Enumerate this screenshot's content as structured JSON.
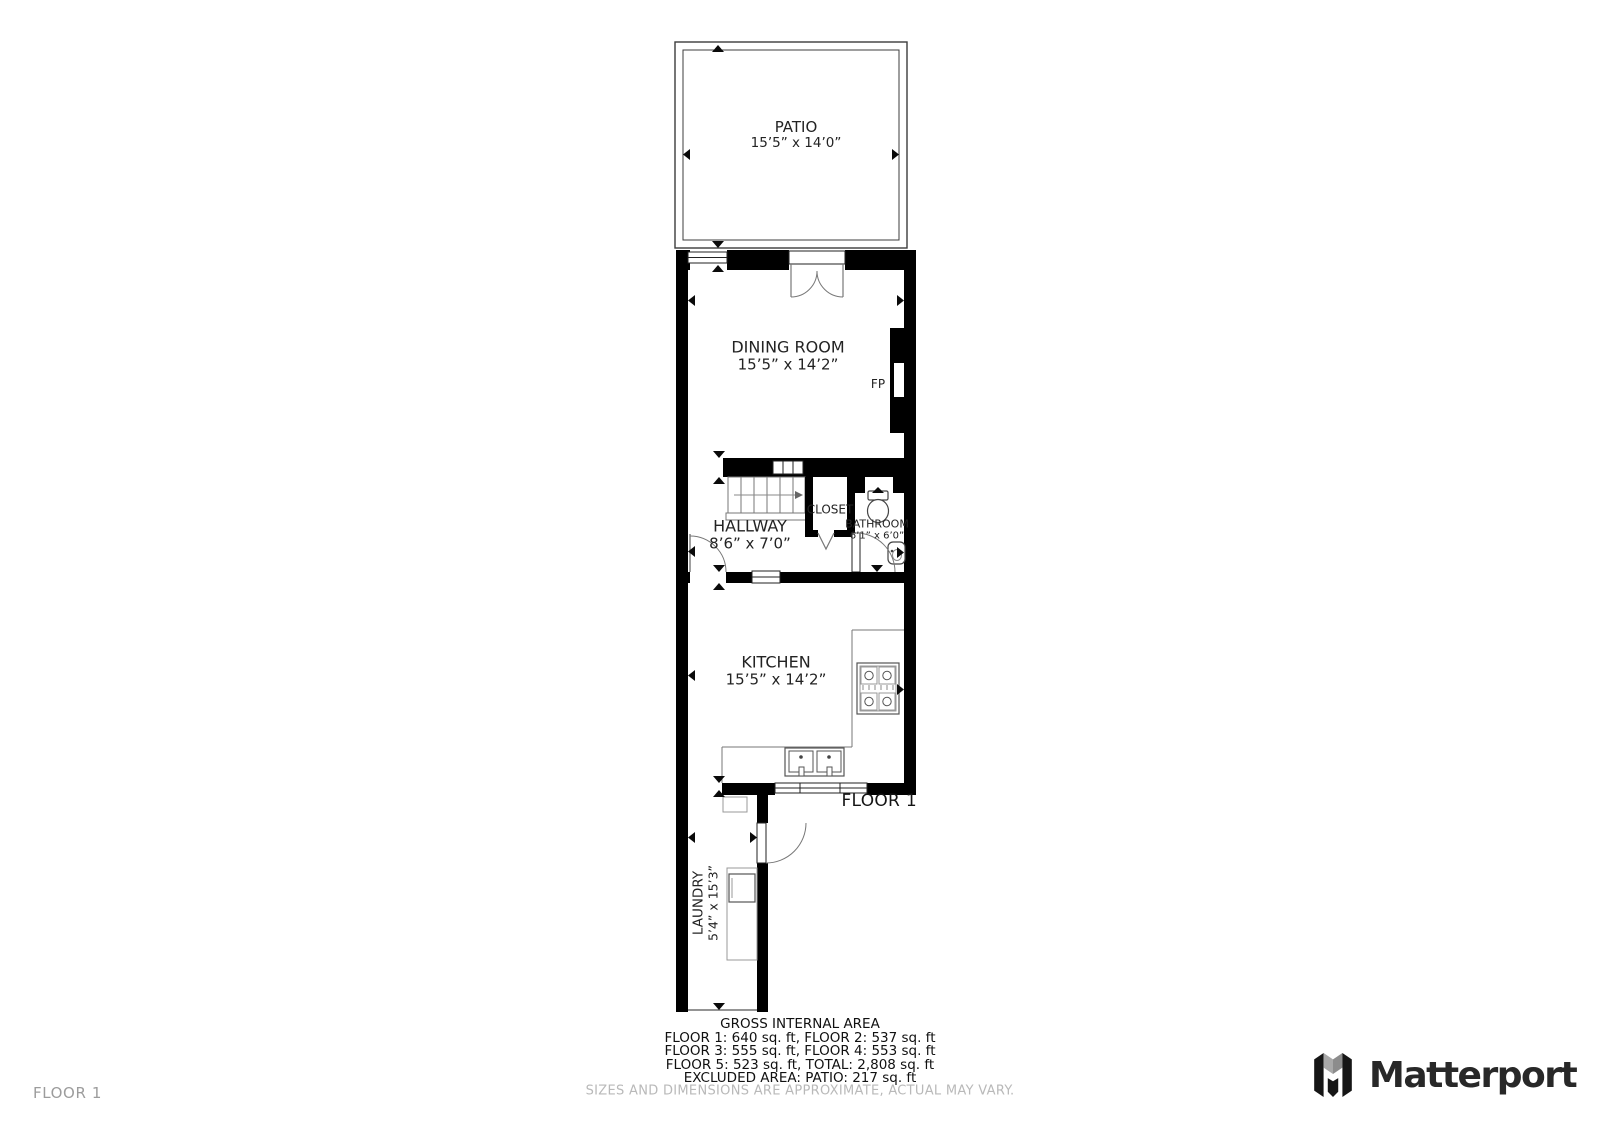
{
  "plan": {
    "floor_label": "FLOOR 1",
    "fireplace_label": "FP",
    "rooms": {
      "patio": {
        "name": "PATIO",
        "dims": "15’5” x 14’0”"
      },
      "dining": {
        "name": "DINING ROOM",
        "dims": "15’5” x 14’2”"
      },
      "hallway": {
        "name": "HALLWAY",
        "dims": "8’6” x 7’0”"
      },
      "closet": {
        "name": "CLOSET"
      },
      "bathroom": {
        "name": "BATHROOM",
        "dims": "6’1” x 6’0”"
      },
      "kitchen": {
        "name": "KITCHEN",
        "dims": "15’5” x 14’2”"
      },
      "laundry": {
        "name": "LAUNDRY",
        "dims": "5’4” x 15’3”"
      }
    }
  },
  "area_summary": {
    "title": "GROSS INTERNAL AREA",
    "lines": [
      "FLOOR 1: 640 sq. ft, FLOOR 2: 537 sq. ft",
      "FLOOR 3: 555 sq. ft, FLOOR 4: 553 sq. ft",
      "FLOOR 5: 523 sq. ft, TOTAL: 2,808 sq. ft",
      "EXCLUDED AREA: PATIO: 217 sq. ft"
    ],
    "disclaimer": "SIZES AND DIMENSIONS ARE APPROXIMATE, ACTUAL MAY VARY."
  },
  "page": {
    "floor_nav_label": "FLOOR 1",
    "brand_name": "Matterport"
  },
  "colors": {
    "wall": "#000000",
    "thin_line": "#777777",
    "muted_text": "#b9b9b9",
    "brand_text": "#282828"
  }
}
